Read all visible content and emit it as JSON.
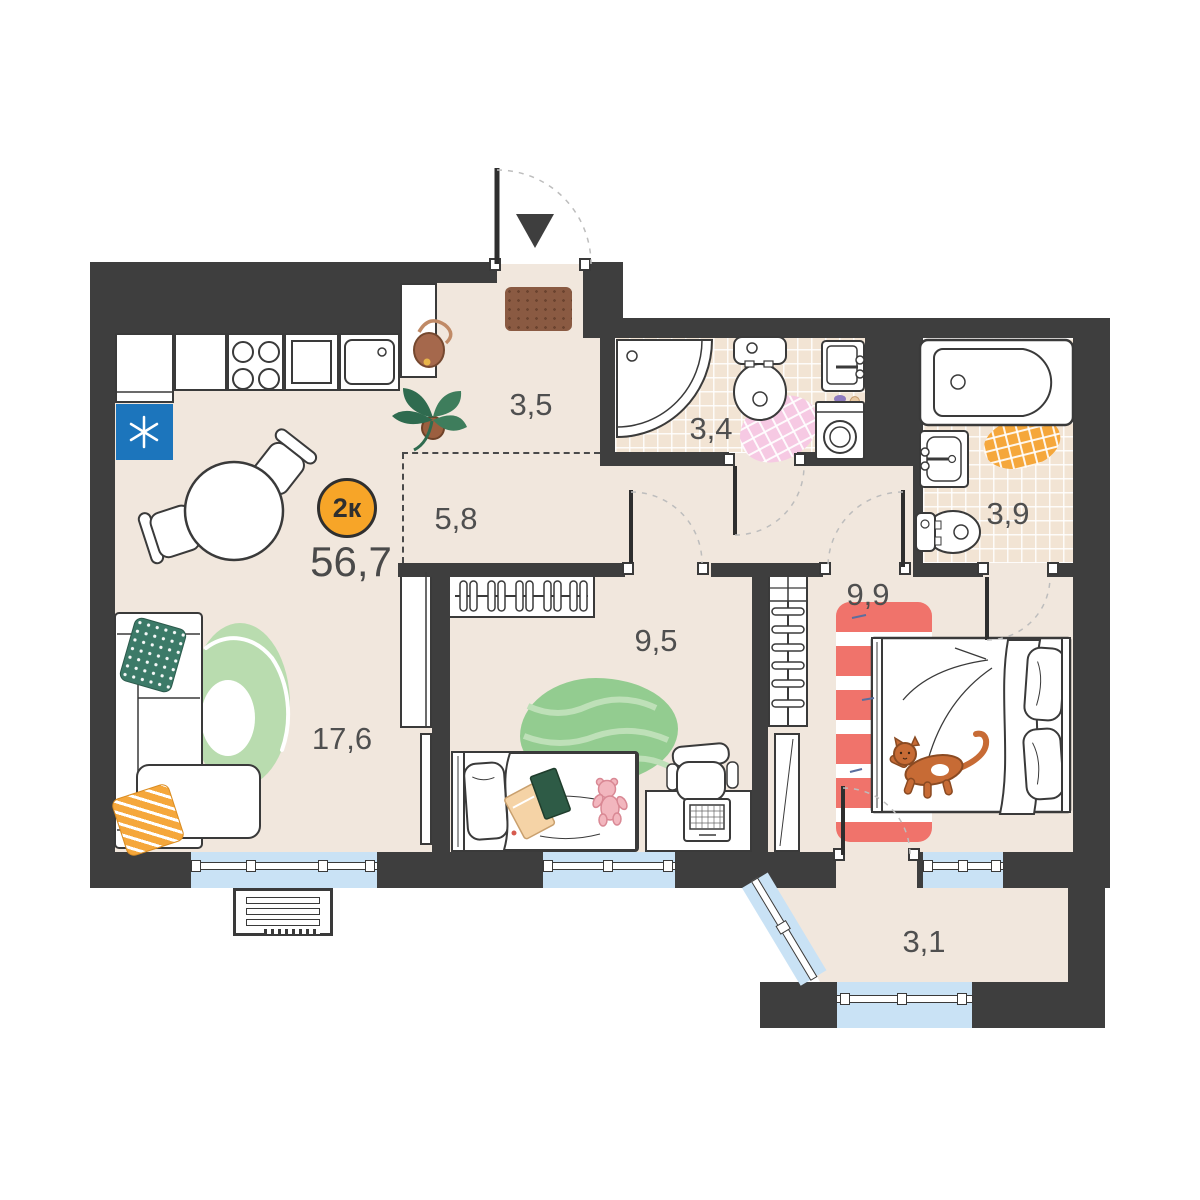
{
  "plan": {
    "type_badge": "2к",
    "total_area": "56,7",
    "rooms": [
      {
        "name": "entrance-hall",
        "area": "3,5"
      },
      {
        "name": "corridor",
        "area": "5,8"
      },
      {
        "name": "bathroom-wc",
        "area": "3,4"
      },
      {
        "name": "bathroom",
        "area": "3,9"
      },
      {
        "name": "bedroom",
        "area": "9,9"
      },
      {
        "name": "kids-room",
        "area": "9,5"
      },
      {
        "name": "kitchen-living-room",
        "area": "17,6"
      },
      {
        "name": "balcony",
        "area": "3,1"
      }
    ],
    "icons": {
      "entrance_marker": "down-triangle",
      "fridge_marker": "snowflake"
    },
    "colors": {
      "wall": "#3E3E3E",
      "floor": "#F1E7DD",
      "tile": "#F2E4D4",
      "glass": "#C9E2F5",
      "accent_orange": "#F7A528",
      "fridge_blue": "#1C75BC",
      "rug_red": "#F0736B",
      "rug_pink": "#F6C9E3",
      "rug_green": "#93CC90",
      "ring_rug_green": "#B9DCAF",
      "pillow_teal": "#3C7A68",
      "cat_orange": "#C76B35"
    }
  }
}
